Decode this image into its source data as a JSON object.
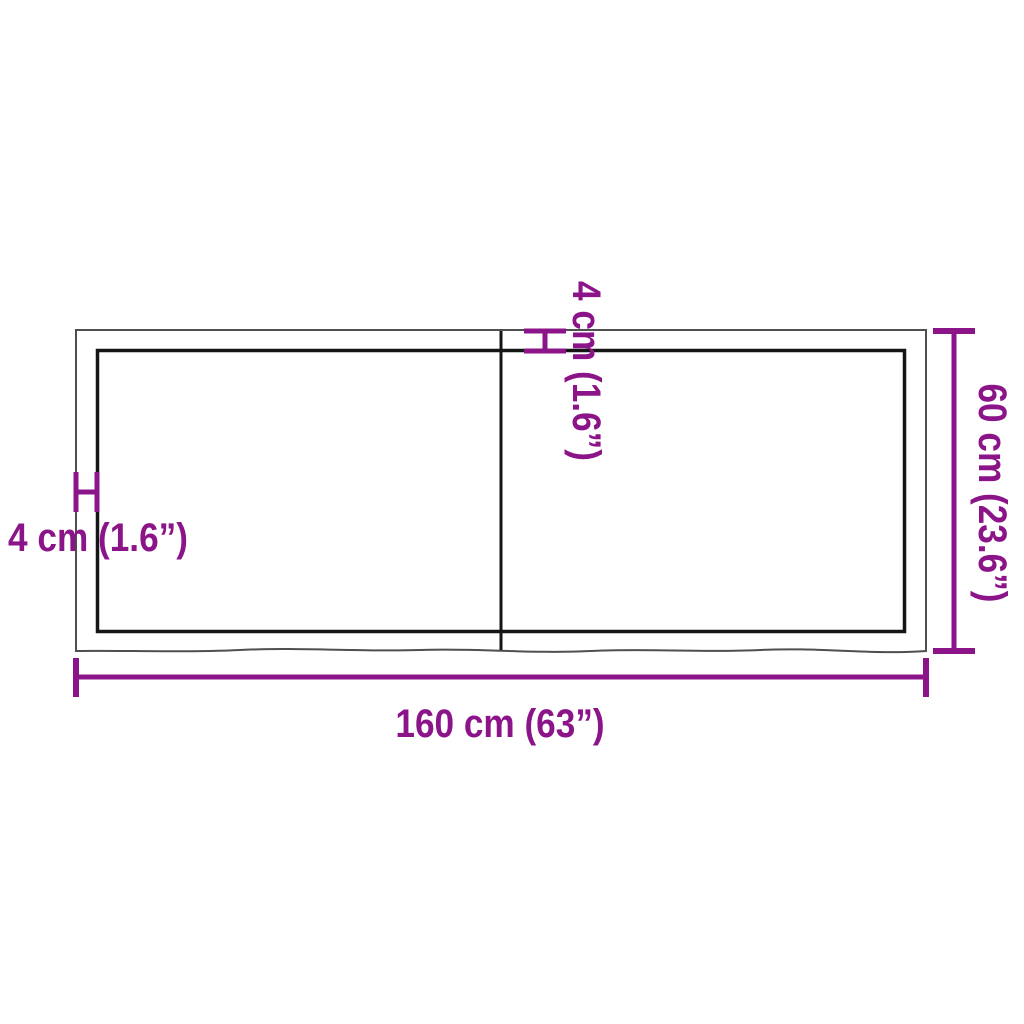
{
  "diagram": {
    "labels": {
      "width": "160 cm (63”)",
      "height": "60 cm (23.6”)",
      "thickness_left": "4 cm (1.6”)",
      "thickness_top": "4 cm (1.6”)"
    },
    "colors": {
      "dimension": "#8c1489",
      "outer_edge": "#4f4f4f",
      "inner_edge": "#151515",
      "background": "#ffffff"
    }
  }
}
